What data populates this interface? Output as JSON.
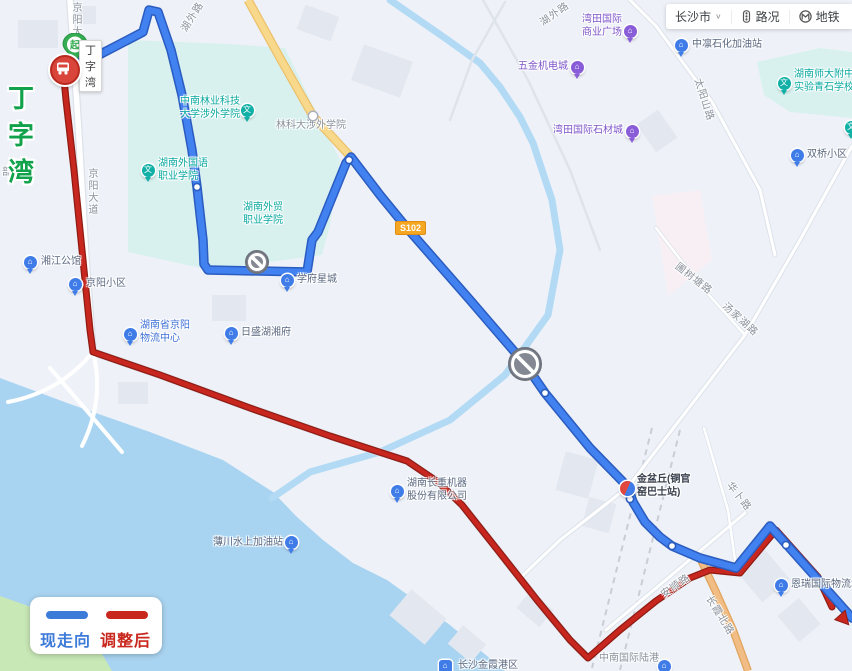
{
  "toolbar": {
    "city": "长沙市",
    "city_caret": "∨",
    "items": [
      {
        "label": "路况",
        "icon": "traffic-light-icon"
      },
      {
        "label": "地铁",
        "icon": "metro-icon"
      }
    ]
  },
  "legend": {
    "current": {
      "label": "现走向",
      "color": "#3d7bd9"
    },
    "adjusted": {
      "label": "调整后",
      "color": "#c8281e"
    }
  },
  "start_marker": {
    "badge": "起",
    "tooltip": "丁字湾"
  },
  "terminus_name": "丁字湾",
  "road_badge": "S102",
  "colors": {
    "route_current": "#4181f0",
    "route_current_casing": "#2b5cc0",
    "route_adjusted": "#c7271e",
    "route_adjusted_casing": "#8f1b13",
    "water": "#a9d4f1",
    "campus": "#d8f1ef",
    "yellow_road": "#f8d88a"
  },
  "road_labels": [
    {
      "text": "京阳大道",
      "x": 68,
      "y": 2,
      "vertical": true
    },
    {
      "text": "京阳大道",
      "x": 84,
      "y": 168,
      "vertical": true
    },
    {
      "text": "湖外路",
      "x": 176,
      "y": 26,
      "rot": -58
    },
    {
      "text": "湖外路",
      "x": 536,
      "y": 16,
      "rot": -35
    },
    {
      "text": "太阳山路",
      "x": 706,
      "y": 76,
      "rot": 72
    },
    {
      "text": "圃树塘路",
      "x": 682,
      "y": 258,
      "rot": 38
    },
    {
      "text": "汤家湖路",
      "x": 730,
      "y": 298,
      "rot": 42
    },
    {
      "text": "华卜路",
      "x": 736,
      "y": 478,
      "rot": 52
    },
    {
      "text": "安顺路",
      "x": 657,
      "y": 588,
      "rot": -35
    },
    {
      "text": "长霞北路",
      "x": 716,
      "y": 592,
      "rot": 58
    },
    {
      "text": "部湾",
      "x": 2,
      "y": 163,
      "rot": 0
    }
  ],
  "pois": [
    {
      "name": "中南林业科技大学涉外学院",
      "lines": [
        "中南林业科技",
        "大学涉外学院"
      ],
      "cls": "teal",
      "tx": 180,
      "ty": 95,
      "tw": 60,
      "align": "right",
      "pin": {
        "type": "teal",
        "x": 247,
        "y": 110
      }
    },
    {
      "name": "林科大涉外学院",
      "lines": [
        "林科大涉外学院"
      ],
      "cls": "gray",
      "tx": 276,
      "ty": 119,
      "pin": {
        "type": "dot",
        "x": 313,
        "y": 116
      }
    },
    {
      "name": "湖南外国语职业学院",
      "lines": [
        "湖南外国语",
        "职业学院"
      ],
      "cls": "teal",
      "tx": 158,
      "ty": 157,
      "pin": {
        "type": "teal",
        "x": 148,
        "y": 170
      }
    },
    {
      "name": "湖南外贸职业学院",
      "lines": [
        "湖南外贸",
        "职业学院"
      ],
      "cls": "teal",
      "tx": 240,
      "ty": 201,
      "tw": 46,
      "align": "center"
    },
    {
      "name": "湖南师大附中实验青石学校",
      "lines": [
        "湖南师大附中",
        "实验青石学校"
      ],
      "cls": "teal",
      "tx": 794,
      "ty": 68,
      "pin": {
        "type": "teal",
        "x": 784,
        "y": 83
      }
    },
    {
      "name": "湘江公馆",
      "lines": [
        "湘江公馆"
      ],
      "cls": "blue",
      "tx": 41,
      "ty": 255,
      "pin": {
        "type": "blue",
        "x": 30,
        "y": 262
      }
    },
    {
      "name": "京阳小区",
      "lines": [
        "京阳小区"
      ],
      "cls": "blue",
      "tx": 86,
      "ty": 277,
      "pin": {
        "type": "blue",
        "x": 75,
        "y": 284
      }
    },
    {
      "name": "湖南省京阳物流中心",
      "lines": [
        "湖南省京阳",
        "物流中心"
      ],
      "cls": "bluestrong",
      "tx": 140,
      "ty": 319,
      "pin": {
        "type": "blue",
        "x": 130,
        "y": 334
      }
    },
    {
      "name": "日盛湖湘府",
      "lines": [
        "日盛湖湘府"
      ],
      "cls": "blue",
      "tx": 241,
      "ty": 326,
      "pin": {
        "type": "blue",
        "x": 231,
        "y": 333
      }
    },
    {
      "name": "学府星城",
      "lines": [
        "学府星城"
      ],
      "cls": "blue",
      "tx": 297,
      "ty": 273,
      "pin": {
        "type": "blue",
        "x": 287,
        "y": 280
      }
    },
    {
      "name": "五金机电城",
      "lines": [
        "五金机电城"
      ],
      "cls": "purple",
      "tx": 518,
      "ty": 60,
      "pin": {
        "type": "purple",
        "x": 577,
        "y": 67
      }
    },
    {
      "name": "湾田国际商业广场",
      "lines": [
        "湾田国际",
        "商业广场"
      ],
      "cls": "purple",
      "tx": 578,
      "ty": 13,
      "tw": 44,
      "align": "right",
      "pin": {
        "type": "purple",
        "x": 630,
        "y": 31
      }
    },
    {
      "name": "湾田国际石材城",
      "lines": [
        "湾田国际石材城"
      ],
      "cls": "purple",
      "tx": 553,
      "ty": 124,
      "pin": {
        "type": "purple",
        "x": 632,
        "y": 131
      }
    },
    {
      "name": "中凛石化加油站",
      "lines": [
        "中凛石化加油站"
      ],
      "cls": "blue",
      "tx": 692,
      "ty": 38,
      "pin": {
        "type": "blue",
        "x": 681,
        "y": 45
      }
    },
    {
      "name": "双桥小区",
      "lines": [
        "双桥小区"
      ],
      "cls": "blue",
      "tx": 807,
      "ty": 148,
      "pin": {
        "type": "blue",
        "x": 797,
        "y": 155
      }
    },
    {
      "name": "金盆丘(铜官窑巴士站)",
      "lines": [
        "金盆丘(铜官",
        "窑巴士站)"
      ],
      "cls": "dark",
      "tx": 637,
      "ty": 473,
      "pin": {
        "type": "busstop",
        "x": 627,
        "y": 488
      }
    },
    {
      "name": "湖南长重机器股份有限公司",
      "lines": [
        "湖南长重机器",
        "股份有限公司"
      ],
      "cls": "blue",
      "tx": 407,
      "ty": 477,
      "pin": {
        "type": "blue",
        "x": 397,
        "y": 491
      }
    },
    {
      "name": "薄川水上加油站",
      "lines": [
        "薄川水上加油站"
      ],
      "cls": "blue",
      "tx": 213,
      "ty": 536,
      "pin": {
        "type": "blue",
        "x": 291,
        "y": 542
      }
    },
    {
      "name": "恩瑞国际物流城",
      "lines": [
        "恩瑞国际物流城"
      ],
      "cls": "blue",
      "tx": 791,
      "ty": 578,
      "pin": {
        "type": "blue",
        "x": 781,
        "y": 585
      }
    },
    {
      "name": "中南国际陆港",
      "lines": [
        "中南国际陆港"
      ],
      "cls": "gray",
      "tx": 599,
      "ty": 652,
      "pin": {
        "type": "blue",
        "x": 664,
        "y": 666
      }
    },
    {
      "name": "长沙金霞港区",
      "lines": [
        "长沙金霞港区"
      ],
      "cls": "blue",
      "tx": 458,
      "ty": 659,
      "pin": {
        "type": "square",
        "x": 445,
        "y": 666
      }
    },
    {
      "name": "partial-pin",
      "lines": [],
      "cls": "teal",
      "tx": 0,
      "ty": 0,
      "pin": {
        "type": "teal",
        "x": 851,
        "y": 127
      }
    }
  ],
  "routes": {
    "current": {
      "label": "现走向",
      "points": "63,68 95,57 143,32 149,10 158,12 171,50 182,95 192,150 197,187 203,240 204,264 208,270 307,272 312,240 318,232 346,163 351,157 380,195 407,228 470,300 525,364 545,393 590,448 628,487 633,502 645,522 660,537 672,546 700,558 736,568 770,526 812,573 852,618",
      "stops": [
        [
          95,
          57
        ],
        [
          197,
          187
        ],
        [
          349,
          160
        ],
        [
          545,
          393
        ],
        [
          630,
          499
        ],
        [
          672,
          546
        ],
        [
          786,
          545
        ]
      ]
    },
    "adjusted": {
      "label": "调整后",
      "points": "63,68 66,100 74,170 83,260 90,330 93,352 160,375 250,408 330,436 407,461 438,482 462,505 500,553 537,600 570,640 588,658 620,630 656,601 690,578 710,570 740,573 776,530 818,577 832,607",
      "arrow": {
        "x": 840,
        "y": 615,
        "rot": 48
      }
    }
  },
  "prohibition_icons": [
    {
      "x": 257,
      "y": 262,
      "r": 11
    },
    {
      "x": 525,
      "y": 364,
      "r": 16
    }
  ]
}
